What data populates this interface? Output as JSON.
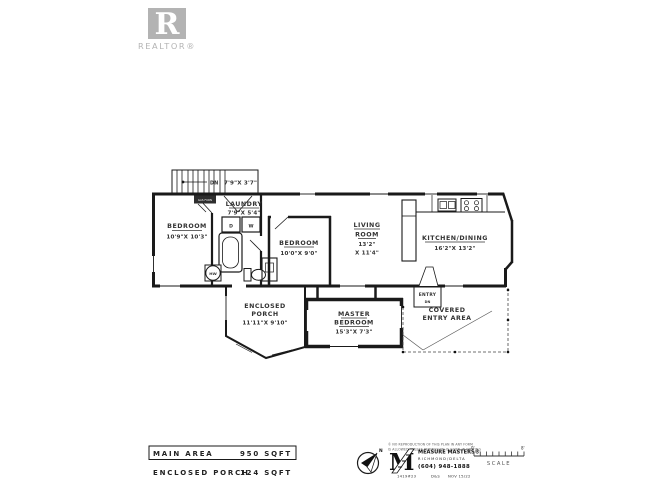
{
  "branding": {
    "logo_letter": "R",
    "logo_label": "REALTOR®"
  },
  "plan": {
    "stairs": {
      "dn": "DN",
      "dims": "7'9\"X 3'7\""
    },
    "furnace_tag": "GAS FURN",
    "rooms": [
      {
        "name": "BEDROOM",
        "dims": "10'9\"X 10'3\""
      },
      {
        "name": "LAUNDRY",
        "dims": "7'9\"X 5'4\""
      },
      {
        "name": "BEDROOM",
        "dims": "10'0\"X 9'0\""
      },
      {
        "name_l1": "LIVING",
        "name_l2": "ROOM",
        "dims_l1": "13'2\"",
        "dims_l2": "X 11'4\""
      },
      {
        "name": "KITCHEN/DINING",
        "dims": "16'2\"X 13'2\""
      },
      {
        "name_l1": "ENCLOSED",
        "name_l2": "PORCH",
        "dims": "11'11\"X 9'10\""
      },
      {
        "name_l1": "MASTER",
        "name_l2": "BEDROOM",
        "dims": "15'3\"X 7'3\""
      },
      {
        "name": "ENTRY",
        "sub": "DN"
      },
      {
        "name_l1": "COVERED",
        "name_l2": "ENTRY AREA"
      }
    ],
    "fixtures": {
      "dryer": "D",
      "washer": "W",
      "hot_water": "HW"
    }
  },
  "summary": {
    "main_area_label": "MAIN AREA",
    "main_area_value": "950 SQFT",
    "porch_label": "ENCLOSED PORCH",
    "porch_value": "124 SQFT"
  },
  "footer": {
    "disclaimer_l1": "© NO REPRODUCTION OF THIS PLAN IN ANY FORM",
    "disclaimer_l2": "IS ALLOWED UNLESS PERMISSION IS GIVEN IN WRITING",
    "north": "N",
    "logo_letter": "M",
    "company": "MEASURE MASTERS®",
    "region": "RICHMOND/DELTA",
    "phone": "(604) 948-1888",
    "job_number": "1419#23",
    "job_code": "D&S",
    "job_date": "NOV 15/22",
    "scale_left": "0'",
    "scale_right": "8'",
    "scale_label": "SCALE",
    "accent_gray": "#b3b3b3",
    "line_black": "#1a1a1a"
  }
}
